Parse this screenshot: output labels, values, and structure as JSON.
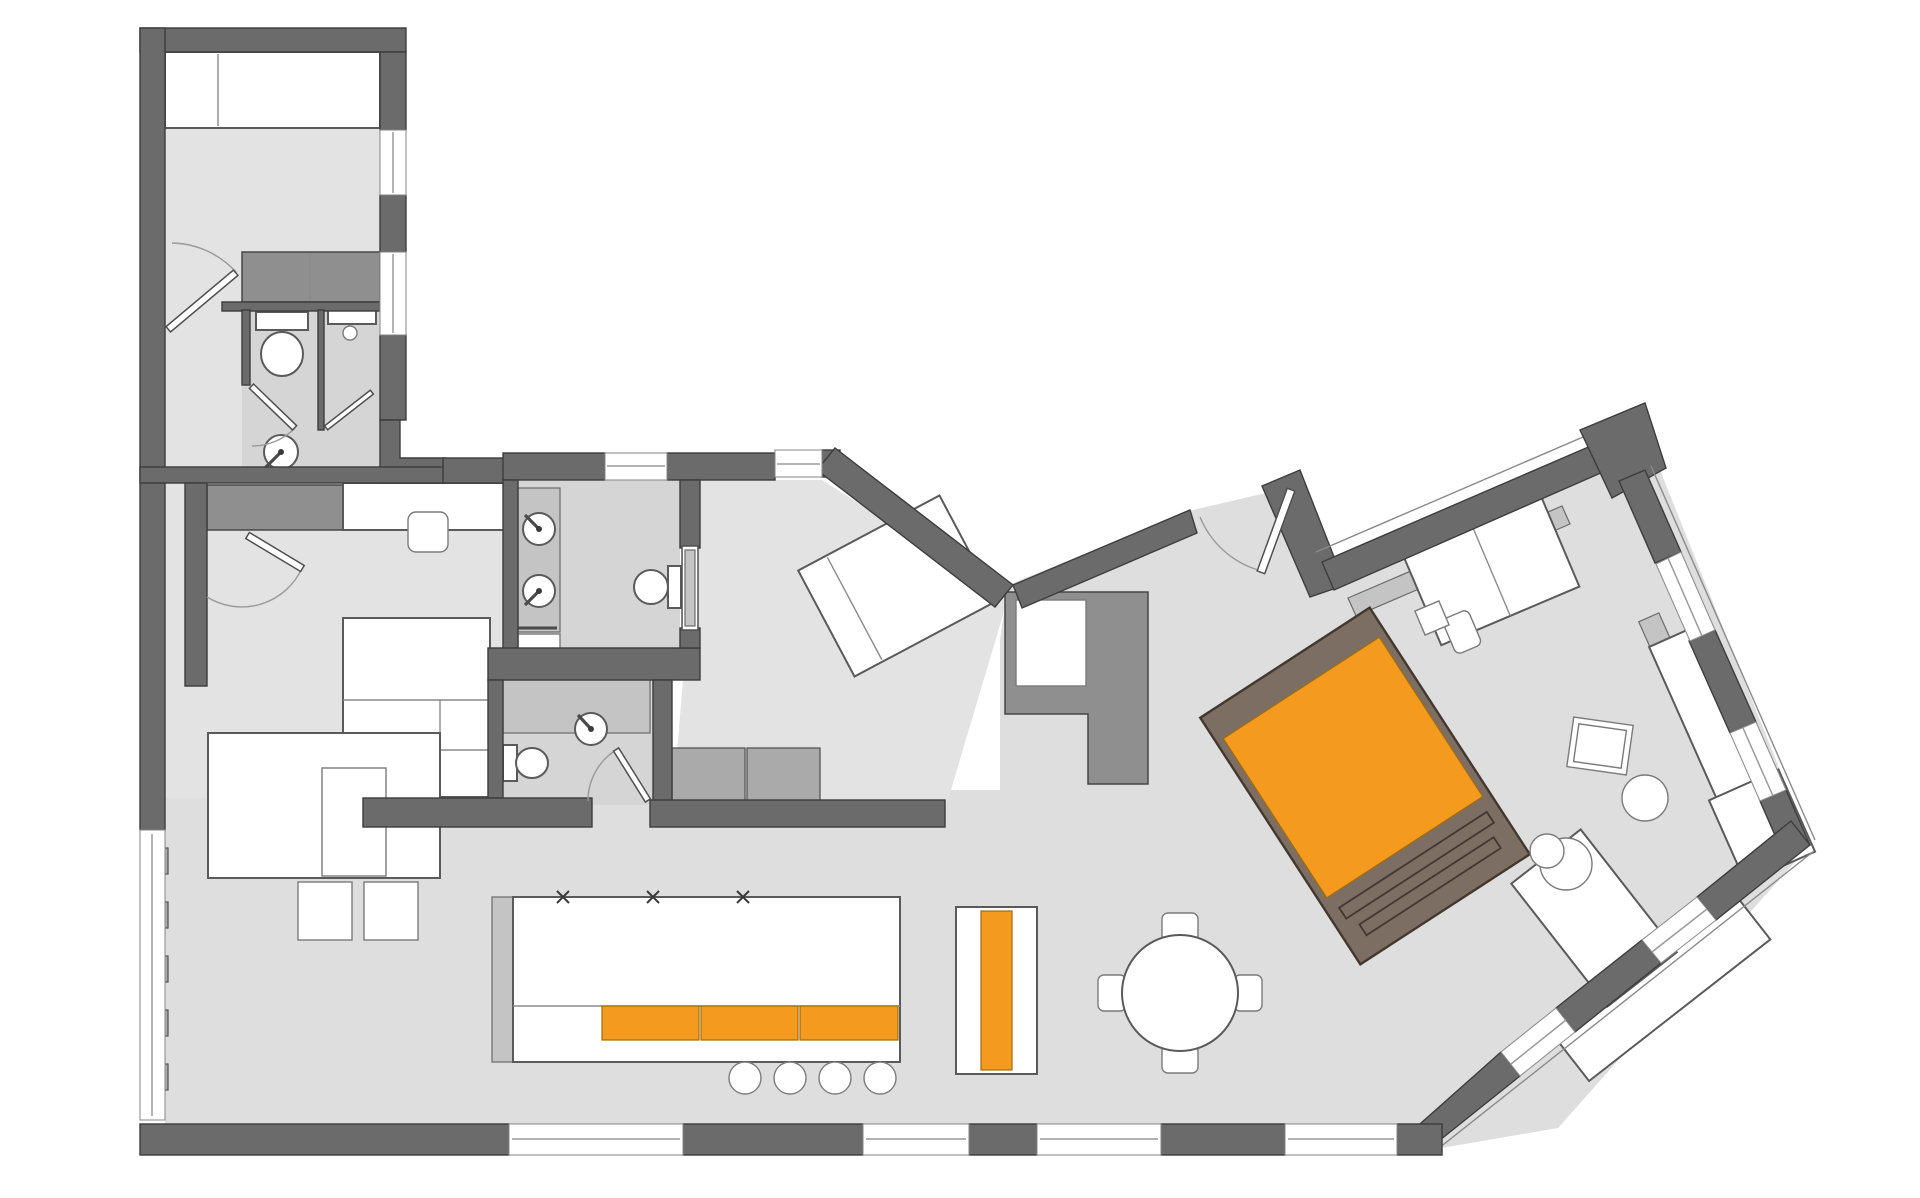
{
  "title": "apartment-floor-plan",
  "palette": {
    "bg": "#ffffff",
    "wall": "#6b6b6b",
    "wall_outline": "#3d3d3d",
    "floor": "#dedede",
    "floor_room": "#e3e3e3",
    "floor_bath": "#d5d5d5",
    "counter": "#c4c4c4",
    "cabinet": "#8f8f8f",
    "closet": "#aaaaaa",
    "orange": "#f39a1f",
    "brown": "#7c6e63",
    "brown_dark": "#43382e"
  },
  "rooms": [
    {
      "name": "bedroom-top-left",
      "fixtures": [
        "bed",
        "wardrobe-cabinets",
        "window-right-wall"
      ]
    },
    {
      "name": "bathroom-1",
      "fixtures": [
        "toilet",
        "washbasin",
        "shower",
        "door"
      ]
    },
    {
      "name": "bedroom-middle-left",
      "fixtures": [
        "desk",
        "chair",
        "wardrobe",
        "double-bed",
        "door"
      ]
    },
    {
      "name": "bathroom-2",
      "fixtures": [
        "double-washbasin",
        "toilet",
        "shower",
        "pocket-door",
        "window"
      ]
    },
    {
      "name": "bathroom-3",
      "fixtures": [
        "vanity-sink",
        "toilet",
        "door"
      ]
    },
    {
      "name": "bedroom-right",
      "fixtures": [
        "rotated-bed",
        "closet-row",
        "window"
      ]
    },
    {
      "name": "living-dining-kitchen",
      "fixtures": [
        "entry-door",
        "wardrobe-L",
        "desk-with-chair",
        "orange-daybed",
        "corner-sofa",
        "side-tables",
        "dining-table-4-chairs",
        "kitchen-island-orange-drawers",
        "bar-stools",
        "orange-runner-console",
        "sofa-with-side-tables",
        "radiator-window-band"
      ]
    }
  ]
}
